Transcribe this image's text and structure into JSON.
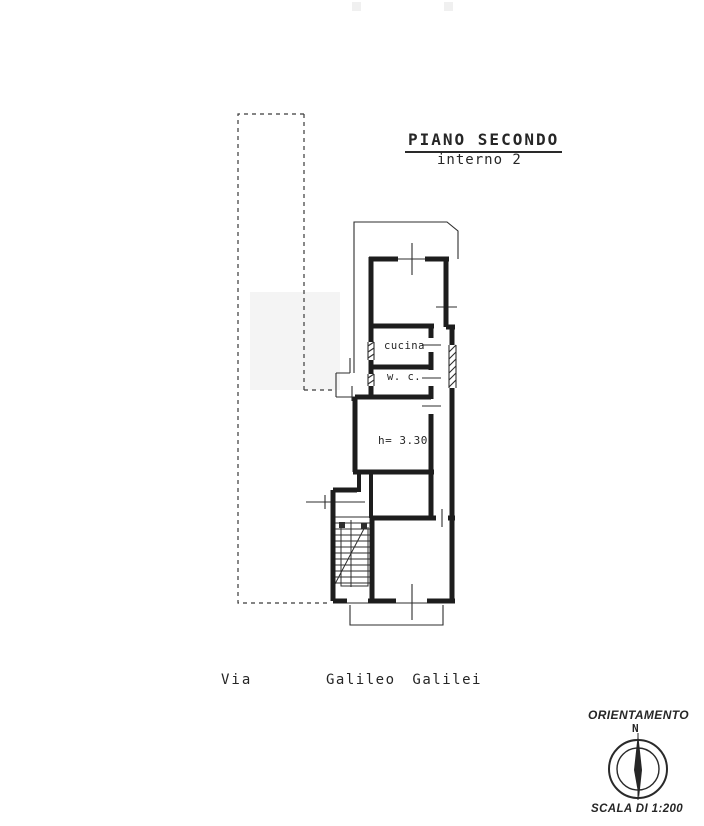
{
  "header": {
    "title": "PIANO SECONDO",
    "subtitle": "interno 2"
  },
  "plan": {
    "labels": {
      "kitchen": "cucina",
      "wc": "w. c.",
      "height_note": "h= 3.30"
    }
  },
  "street": {
    "prefix": "Via",
    "name": "Galileo Galilei"
  },
  "orientation": {
    "title": "ORIENTAMENTO",
    "north": "N"
  },
  "scale": {
    "label": "SCALA DI 1:200"
  },
  "colors": {
    "ink": "#262626",
    "wall": "#1d1d1d",
    "paper": "#ffffff"
  }
}
